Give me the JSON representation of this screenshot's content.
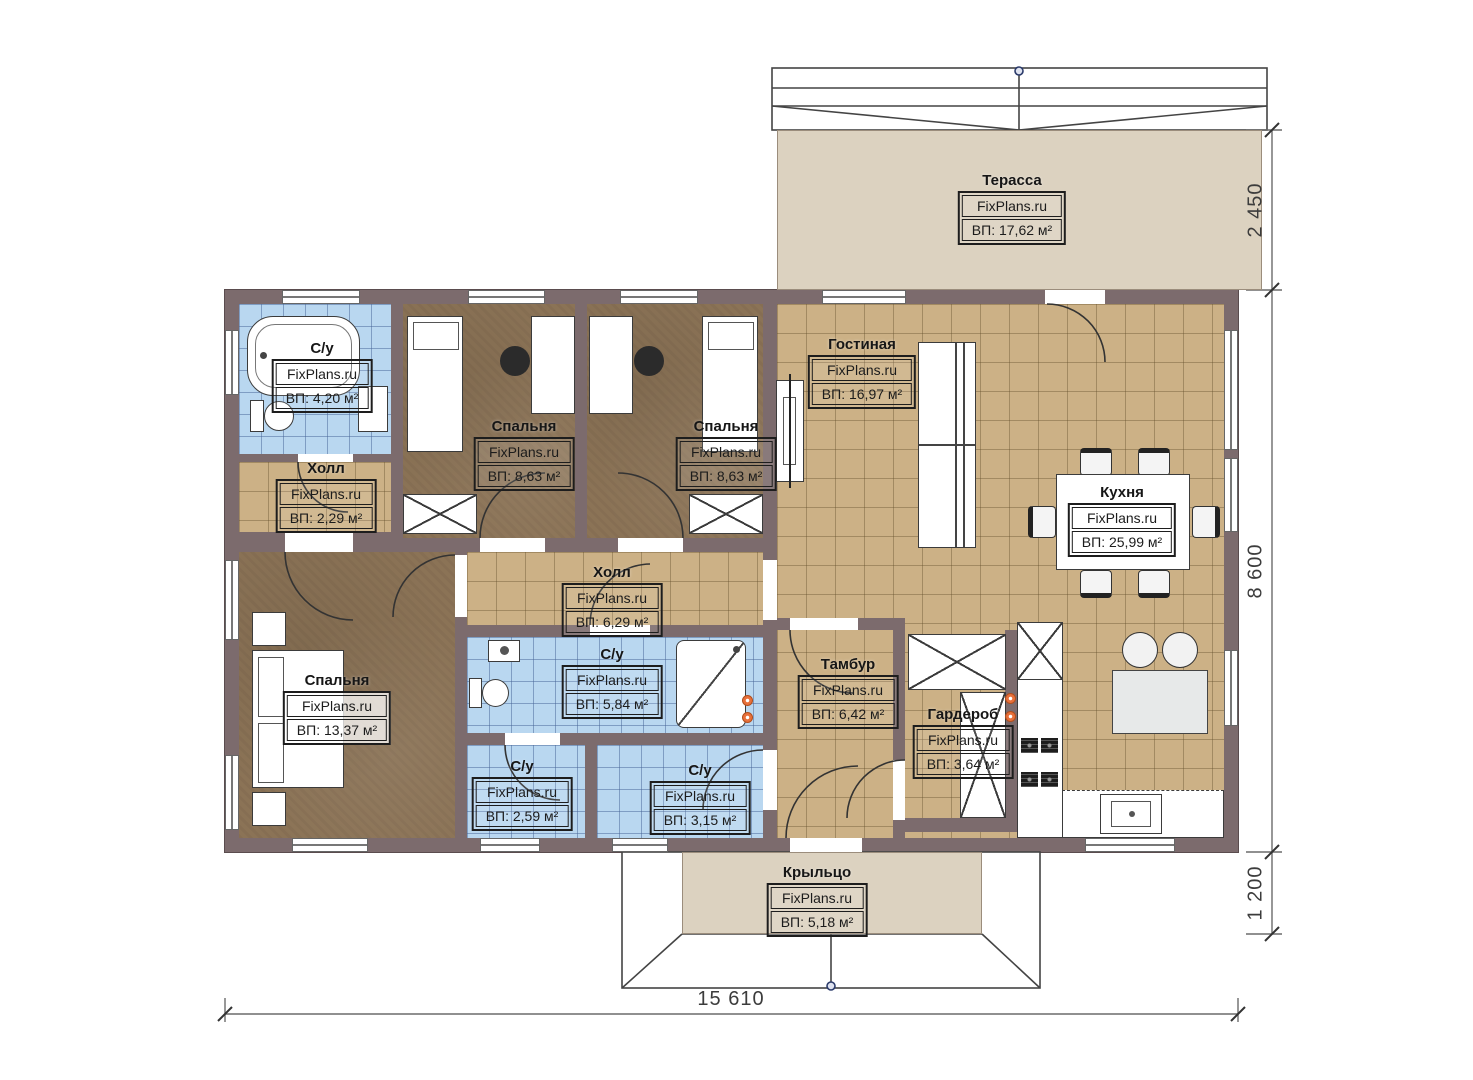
{
  "brand": "FixPlans.ru",
  "rooms": {
    "terrace": {
      "name": "Терасса",
      "brand": "FixPlans.ru",
      "area": "ВП: 17,62 м²"
    },
    "bath1": {
      "name": "С/у",
      "brand": "FixPlans.ru",
      "area": "ВП: 4,20 м²"
    },
    "hall1": {
      "name": "Холл",
      "brand": "FixPlans.ru",
      "area": "ВП: 2,29 м²"
    },
    "bedroom1": {
      "name": "Спальня",
      "brand": "FixPlans.ru",
      "area": "ВП: 8,63 м²"
    },
    "bedroom2": {
      "name": "Спальня",
      "brand": "FixPlans.ru",
      "area": "ВП: 8,63 м²"
    },
    "living": {
      "name": "Гостиная",
      "brand": "FixPlans.ru",
      "area": "ВП: 16,97 м²"
    },
    "kitchen": {
      "name": "Кухня",
      "brand": "FixPlans.ru",
      "area": "ВП: 25,99 м²"
    },
    "hall2": {
      "name": "Холл",
      "brand": "FixPlans.ru",
      "area": "ВП: 6,29 м²"
    },
    "bath2": {
      "name": "С/у",
      "brand": "FixPlans.ru",
      "area": "ВП: 5,84 м²"
    },
    "tambour": {
      "name": "Тамбур",
      "brand": "FixPlans.ru",
      "area": "ВП: 6,42 м²"
    },
    "wardrobe": {
      "name": "Гардероб",
      "brand": "FixPlans.ru",
      "area": "ВП: 3,64 м²"
    },
    "bedroom3": {
      "name": "Спальня",
      "brand": "FixPlans.ru",
      "area": "ВП: 13,37 м²"
    },
    "bath3": {
      "name": "С/у",
      "brand": "FixPlans.ru",
      "area": "ВП: 2,59 м²"
    },
    "bath4": {
      "name": "С/у",
      "brand": "FixPlans.ru",
      "area": "ВП: 3,15 м²"
    },
    "porch": {
      "name": "Крыльцо",
      "brand": "FixPlans.ru",
      "area": "ВП: 5,18 м²"
    }
  },
  "dimensions": {
    "right_top": "2 450",
    "right_middle": "8 600",
    "right_bottom": "1 200",
    "bottom": "15 610"
  },
  "colors": {
    "wall": "#7c6b6d",
    "floor_tile": "#ccb186",
    "floor_bath": "#b9d7f0",
    "floor_bedroom": "#8b7356",
    "outdoor": "#dcd2c0",
    "outlet": "#e8703a"
  }
}
